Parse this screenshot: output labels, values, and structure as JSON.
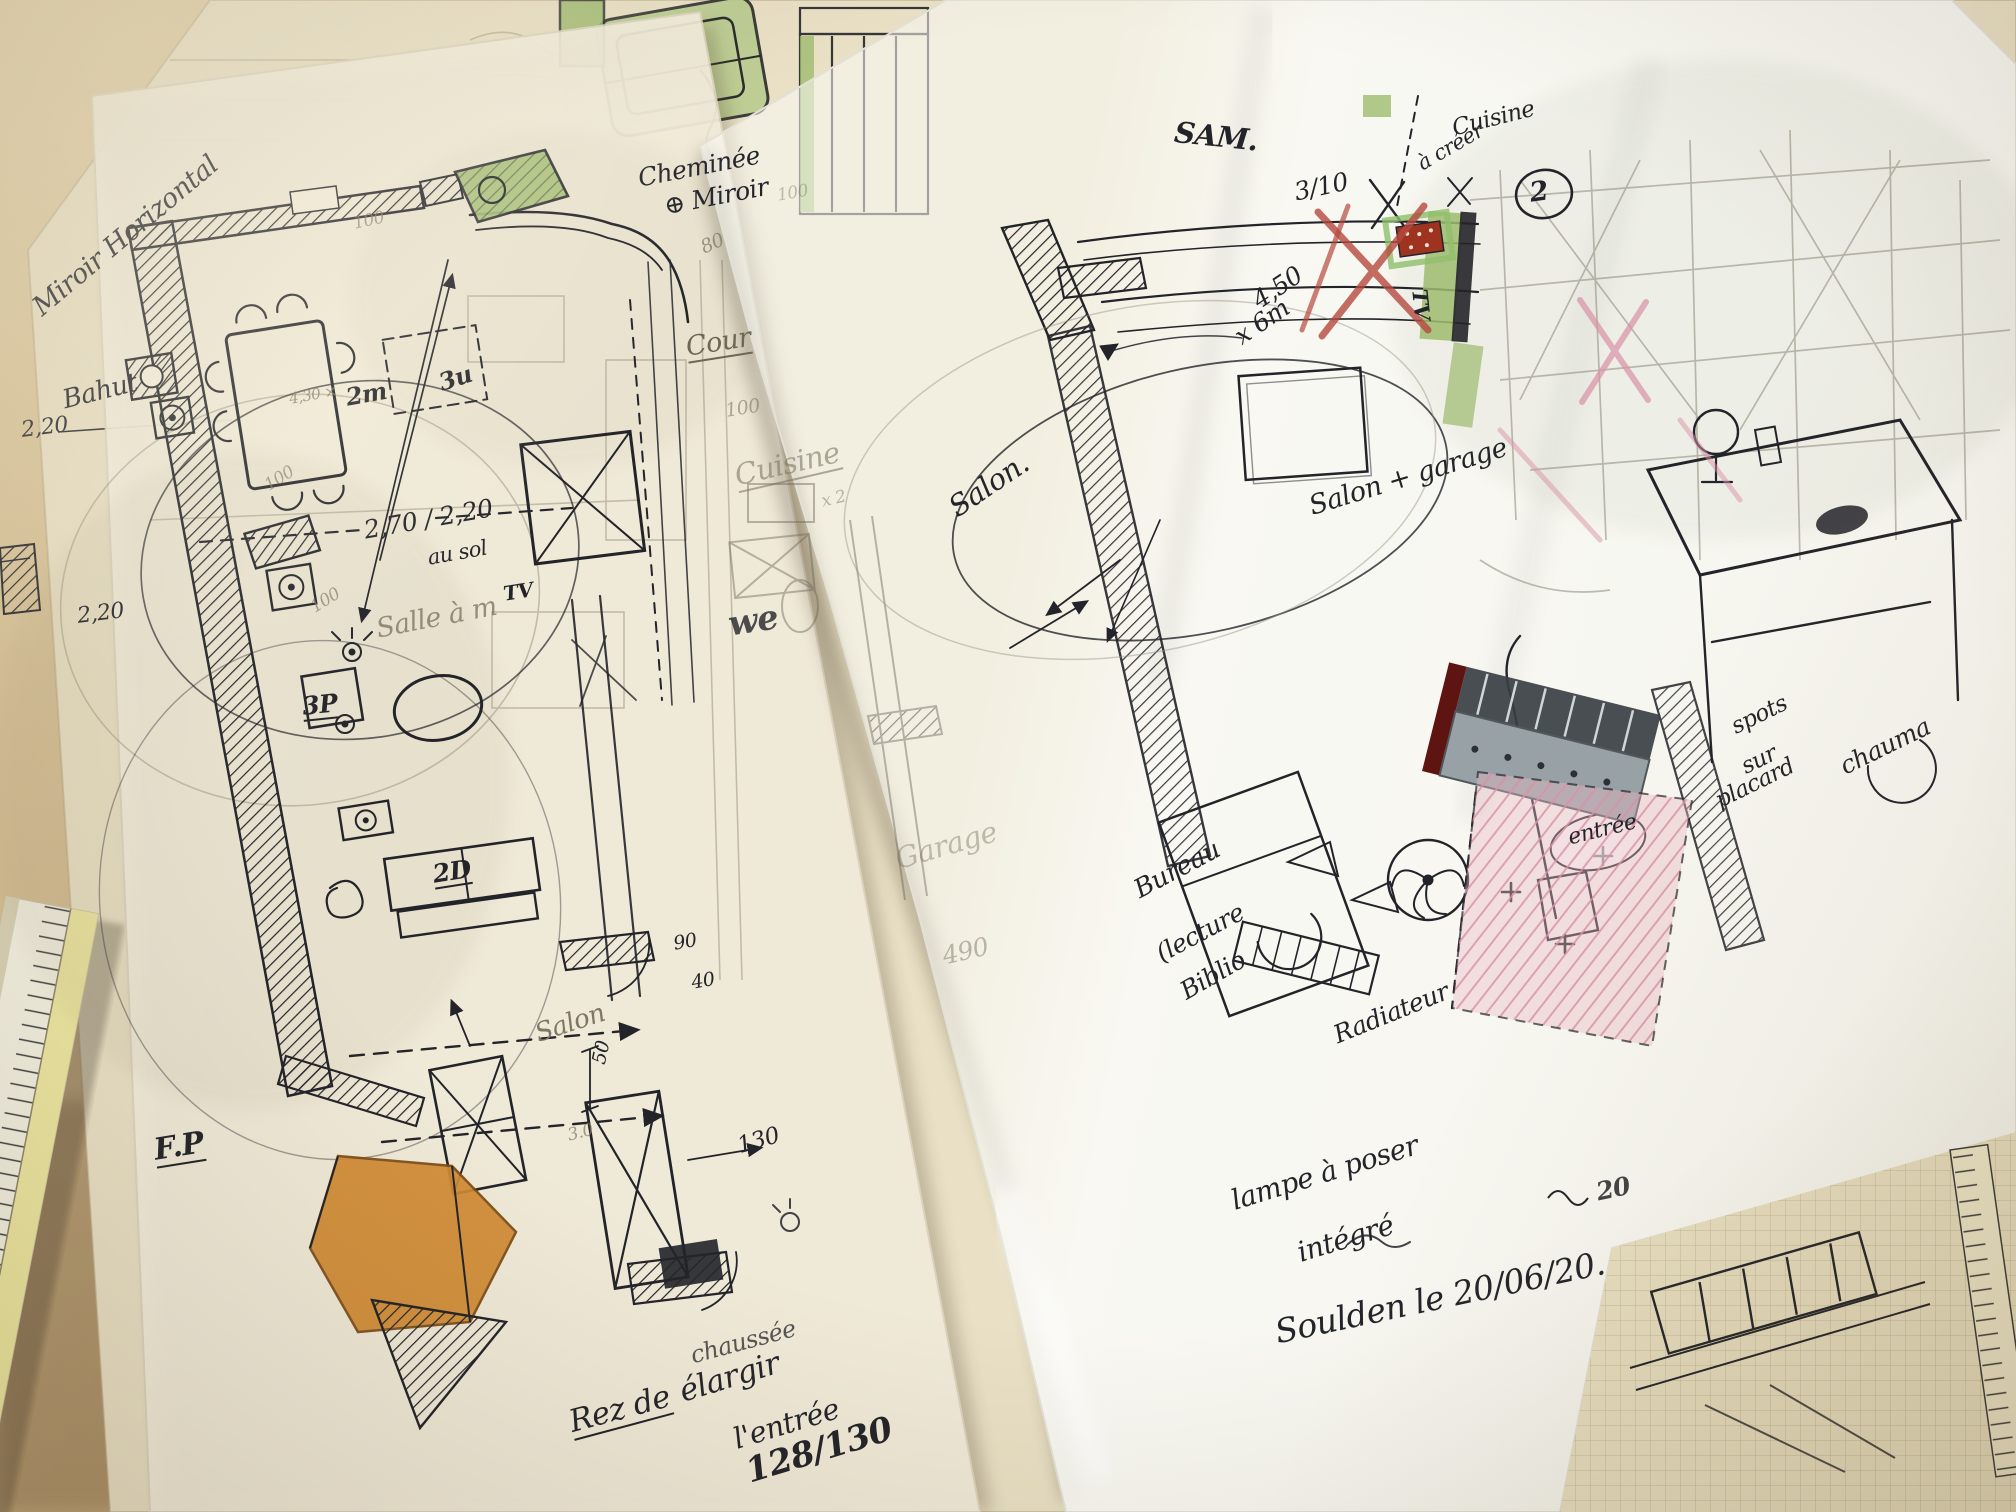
{
  "scene": {
    "description": "Photograph of two hand-drawn floor plan sketches in ink on overlapping tracing paper sheets, lying on a wooden desk with a ruler at lower left",
    "colors": {
      "desk": "#c9b187",
      "base_paper": "#e9e0c5",
      "left_sheet": "#f4eedd",
      "right_sheet": "#fafaf6",
      "ink": "#23242a",
      "pencil": "#7e7763",
      "highlight_green": "#9dbb6d",
      "highlight_orange": "#d08a33",
      "marker_red": "#b5493f",
      "marker_pink": "#d992a6",
      "cabinet_gray": "#98a2a6"
    }
  },
  "left": {
    "miroir_horizontal": "Miroir Horizontal",
    "bahut": "Bahut",
    "dim_430": "4,30 ×",
    "dim_2m": "2m",
    "dim_3u": "3u",
    "cheminee_1": "Cheminée",
    "cheminee_2": "⊕ Miroir",
    "dim_80": "80",
    "cour": "Cour",
    "dim_100_cour": "100",
    "cuisine": "Cuisine",
    "dim_x2": "x 2",
    "wc": "we",
    "dim_270": "2,70 / 2,20",
    "au_sol": "au sol",
    "tv": "TV",
    "salle": "Salle à m",
    "p3": "3P",
    "d2": "2D",
    "fp": "F.P",
    "salon": "Salon",
    "dim_50": "50",
    "dim_30": "3.0",
    "dim_130": "130",
    "dim_90": "90",
    "dim_40": "40",
    "dim_220_a": "2,20",
    "dim_220_b": "2,20",
    "dim_100_a": "100",
    "dim_100_b": "100",
    "dim_100_c": "100",
    "rez_1": "Rez de",
    "rez_2": "élargir",
    "rez_3": "chaussée",
    "entree": "l'entrée",
    "ratio": "128/130"
  },
  "right": {
    "sam": "SAM.",
    "dim_310": "3/10",
    "a_creer": "à créer",
    "cuisine": "Cuisine",
    "num2": "2",
    "dim_450": "4,50",
    "dim_6m": "x 6m",
    "salon": "Salon.",
    "salon_garage": "Salon + garage",
    "tv": "TV",
    "spots_1": "spots",
    "spots_2": "sur",
    "spots_3": "placard",
    "chauma": "chauma",
    "entree": "entrée",
    "bureau_1": "Bureau",
    "bureau_2": "(lecture",
    "bureau_3": "Biblio",
    "radiateur": "Radiateur",
    "lampe_1": "lampe à poser",
    "lampe_2": "intégré",
    "date": "Soulden le 20/06/20."
  },
  "under": {
    "garage": "Garage",
    "dim_490": "490",
    "dim_100_top": "100",
    "page_20": "20"
  }
}
